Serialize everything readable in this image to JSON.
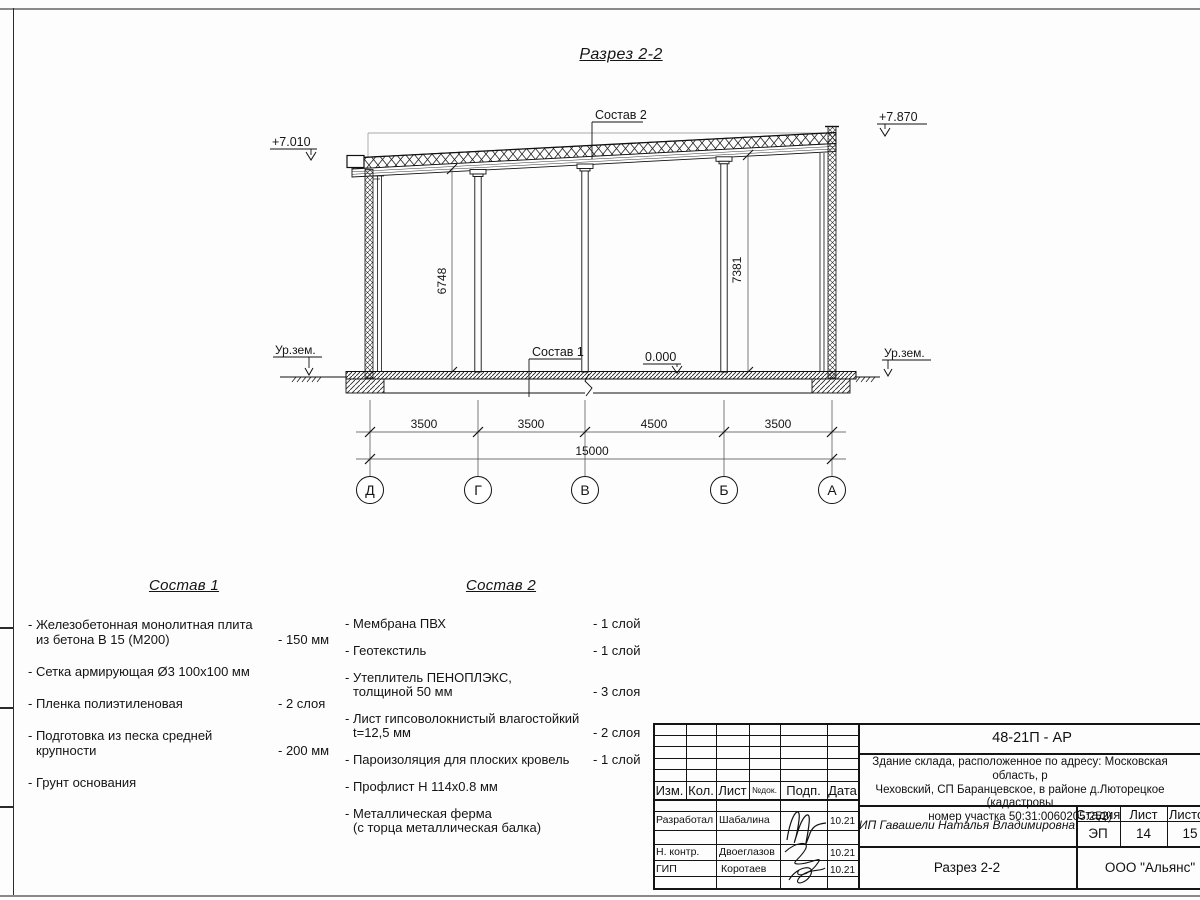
{
  "sheet": {
    "title": "Разрез 2-2"
  },
  "drawing": {
    "levels": {
      "left_roof": "+7.010",
      "right_roof": "+7.870",
      "floor": "0.000",
      "ground_left": "Ур.зем.",
      "ground_right": "Ур.зем."
    },
    "leaders": {
      "roof": "Состав 2",
      "floor": "Состав 1"
    },
    "vertical_dims": {
      "left": "6748",
      "right": "7381"
    },
    "dims": [
      "3500",
      "3500",
      "4500",
      "3500"
    ],
    "total_dim": "15000",
    "axes": [
      "Д",
      "Г",
      "В",
      "Б",
      "А"
    ]
  },
  "compositions": [
    {
      "title": "Состав 1",
      "items": [
        {
          "line1": "- Железобетонная  монолитная плита",
          "line2": "из бетона В 15 (М200)",
          "value": "- 150 мм"
        },
        {
          "line1": "- Сетка армирующая Ø3 100х100 мм",
          "line2": "",
          "value": ""
        },
        {
          "line1": "- Пленка полиэтиленовая",
          "line2": "",
          "value": "- 2 слоя"
        },
        {
          "line1": "- Подготовка из песка средней",
          "line2": "крупности",
          "value": "- 200 мм"
        },
        {
          "line1": "- Грунт основания",
          "line2": "",
          "value": ""
        }
      ]
    },
    {
      "title": "Состав 2",
      "items": [
        {
          "line1": "- Мембрана ПВХ",
          "line2": "",
          "value": "- 1 слой"
        },
        {
          "line1": "- Геотекстиль",
          "line2": "",
          "value": "- 1 слой"
        },
        {
          "line1": "- Утеплитель ПЕНОПЛЭКС,",
          "line2": "толщиной 50 мм",
          "value": "- 3 слоя"
        },
        {
          "line1": "- Лист гипсоволокнистый влагостойкий",
          "line2": "t=12,5 мм",
          "value": "- 2 слоя"
        },
        {
          "line1": "- Пароизоляция для плоских кровель",
          "line2": "",
          "value": "- 1 слой"
        },
        {
          "line1": "- Профлист Н 114х0.8 мм",
          "line2": "",
          "value": ""
        },
        {
          "line1": "- Металлическая ферма",
          "line2": "(с торца металлическая балка)",
          "value": ""
        }
      ]
    }
  ],
  "title_block": {
    "code": "48-21П - АР",
    "address_lines": [
      "Здание склада, расположенное по адресу: Московская область, р",
      "Чеховский, СП Баранцевское, в районе д.Люторецкое  (кадастровы",
      "номер участка 50:31:0060205:252)"
    ],
    "rev_header": [
      "Изм.",
      "Кол.",
      "Лист",
      "№док.",
      "Подп.",
      "Дата"
    ],
    "roles": [
      {
        "role": "Разработал",
        "name": "Шабалина",
        "date": "10.21"
      },
      {
        "role": "Н. контр.",
        "name": "Двоеглазов",
        "date": "10.21"
      },
      {
        "role": "ГИП",
        "name": "Коротаев",
        "date": "10.21"
      }
    ],
    "client": "ИП Гавашели Наталья Владимировна",
    "stage_label": "Стадия",
    "sheet_label": "Лист",
    "sheets_label": "Листов",
    "stage": "ЭП",
    "sheet_no": "14",
    "sheets_total": "15",
    "doc_title": "Разрез 2-2",
    "company": "ООО \"Альянс\""
  }
}
